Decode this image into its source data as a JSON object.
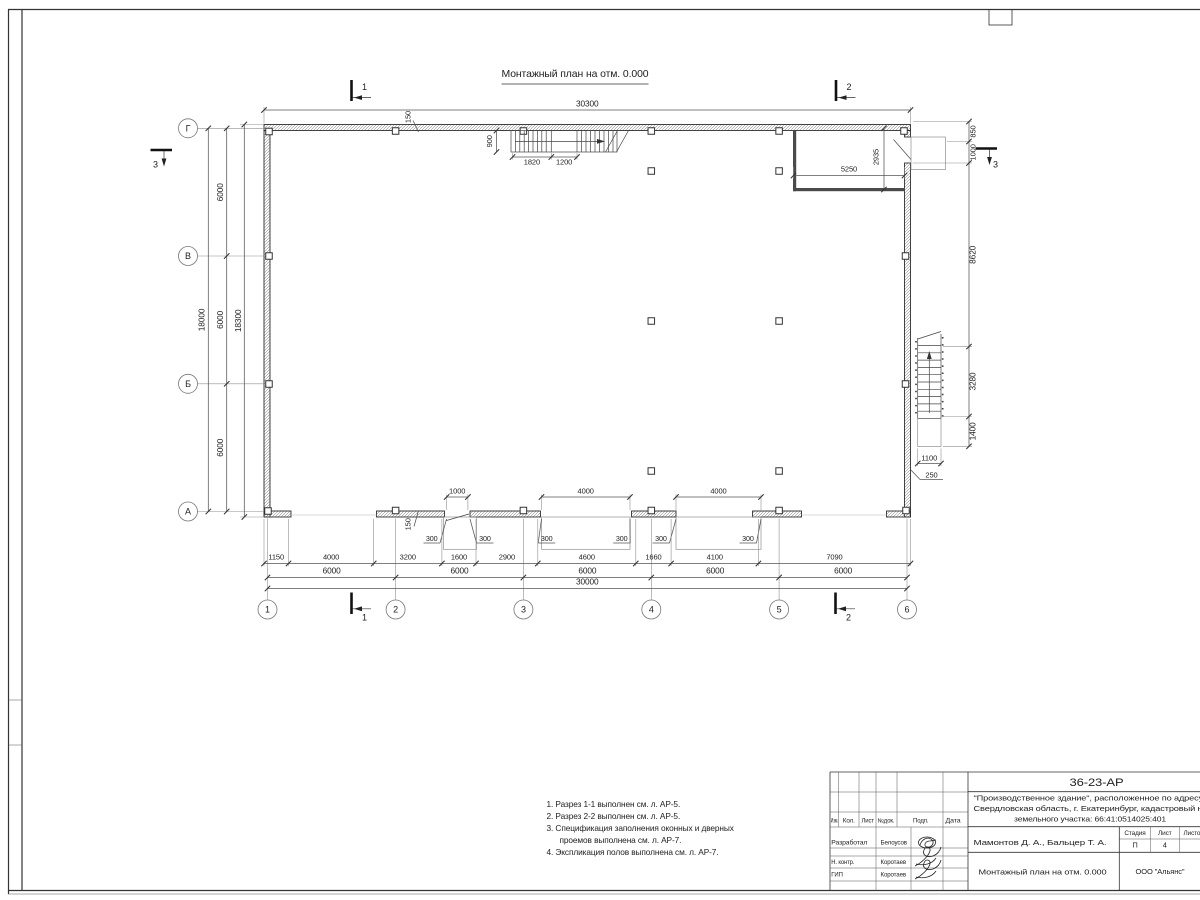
{
  "plan": {
    "title": "Монтажный план на отм. 0.000",
    "dim_top_total": "30300",
    "left_dims": {
      "bay1": "6000",
      "bay2": "6000",
      "bay3": "6000",
      "total": "18000",
      "overall": "18300"
    },
    "right_chain": {
      "d1": "850",
      "d2": "1000",
      "d3": "8620",
      "d4": "3280",
      "d5": "1400"
    },
    "stair_right": {
      "width": "1100",
      "wall": "250"
    },
    "stair_top": {
      "width": "900",
      "flight": "1820",
      "landing": "1200"
    },
    "room": {
      "w": "5250",
      "h": "2935"
    },
    "wall_thickness": "150",
    "openings": {
      "door": "1000",
      "gate1": "4000",
      "gate2": "4000",
      "jamb": "300"
    },
    "bottom_row1": [
      "1150",
      "4000",
      "3200",
      "1600",
      "2900",
      "4600",
      "1660",
      "4100",
      "7090"
    ],
    "bottom_row2": [
      "6000",
      "6000",
      "6000",
      "6000",
      "6000"
    ],
    "bottom_total": "30000",
    "axes_rows": [
      "Г",
      "В",
      "Б",
      "А"
    ],
    "axes_cols": [
      "1",
      "2",
      "3",
      "4",
      "5",
      "6"
    ],
    "sections": {
      "s1": "1",
      "s2": "2",
      "s3": "3"
    }
  },
  "notes": [
    "1. Разрез 1-1 выполнен см. л. АР-5.",
    "2. Разрез 2-2 выполнен см. л. АР-5.",
    "3. Спецификация заполнения оконных и дверных",
    "проемов выполнена см. л. АР-7.",
    "4. Экспликация полов выполнена см. л. АР-7."
  ],
  "title_block": {
    "doc_number": "36-23-АР",
    "project_line1": "\"Производственное здание\", расположенное по адресу:",
    "project_line2": "Свердловская область, г. Екатеринбург, кадастровый н",
    "project_line3": "земельного участка: 66:41:0514025:401",
    "cols": {
      "izm": "Изм.",
      "kol": "Кол.",
      "list": "Лист",
      "ndok": "№док.",
      "podp": "Подп.",
      "data": "Дата"
    },
    "roles": [
      {
        "role": "Разработал",
        "name": "Белоусов"
      },
      {
        "role": "Н. контр.",
        "name": "Коротаев"
      },
      {
        "role": "ГИП",
        "name": "Коротаев"
      }
    ],
    "authors": "Мамонтов Д. А., Бальцер Т. А.",
    "stage_label": "Стадия",
    "sheet_label": "Лист",
    "sheets_label": "Листов",
    "stage": "П",
    "sheet_num": "4",
    "drawing_title": "Монтажный план на отм. 0.000",
    "company": "ООО \"Альянс\""
  }
}
